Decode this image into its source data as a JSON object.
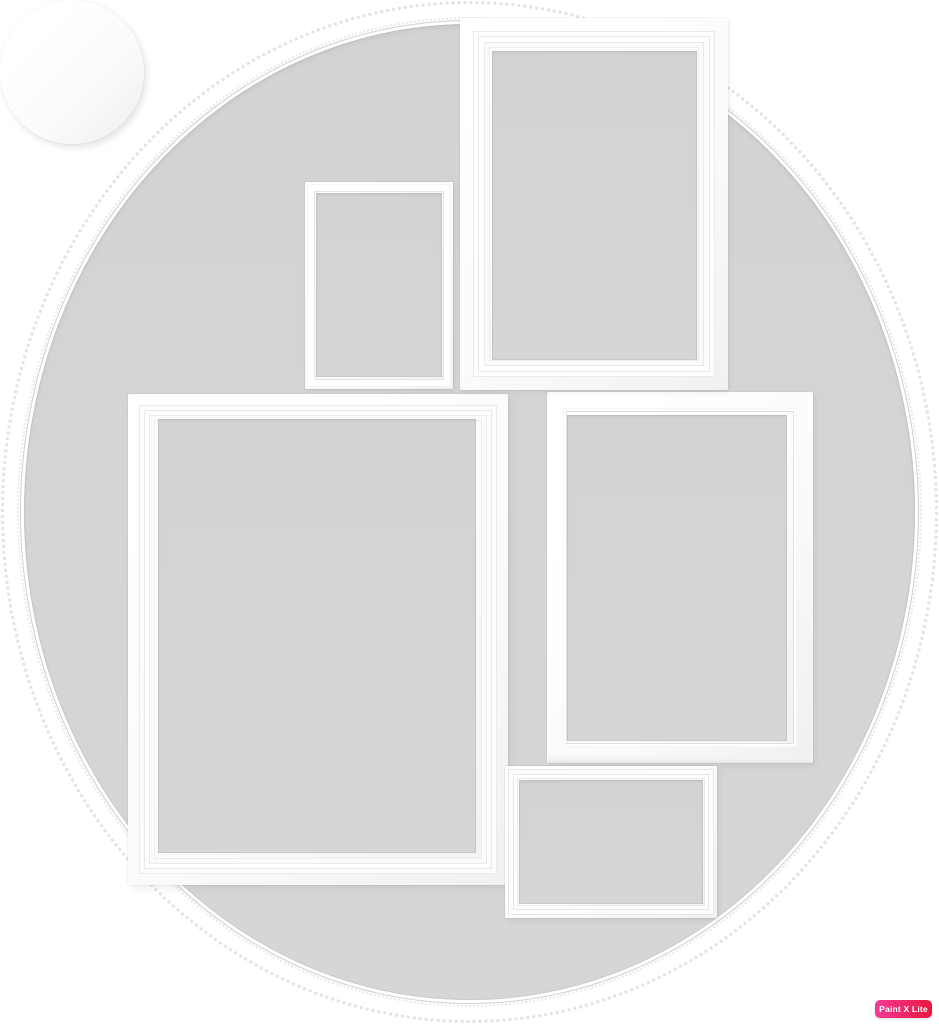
{
  "window": {
    "width_px": 939,
    "height_px": 1024
  },
  "scene": {
    "kind": "product-photo",
    "subject": "Wall collage of six empty white picture frames on a white background",
    "background_color": "#ffffff",
    "frame_color": "#ffffff",
    "opening_color": "#d4d5d5",
    "frames": [
      {
        "id": "frame-portrait-large-top-right",
        "shape": "rectangle",
        "orientation": "portrait",
        "profile": "molded"
      },
      {
        "id": "frame-portrait-small-upper-middle",
        "shape": "rectangle",
        "orientation": "portrait",
        "profile": "thin-flat"
      },
      {
        "id": "frame-round-left",
        "shape": "circle",
        "profile": "beaded"
      },
      {
        "id": "frame-portrait-xlarge-lower-left",
        "shape": "rectangle",
        "orientation": "portrait",
        "profile": "molded"
      },
      {
        "id": "frame-portrait-medium-right",
        "shape": "rectangle",
        "orientation": "portrait",
        "profile": "flat-deep"
      },
      {
        "id": "frame-landscape-small-bottom",
        "shape": "rectangle",
        "orientation": "landscape",
        "profile": "double-ridge"
      }
    ]
  },
  "watermark": {
    "label": "Paint X Lite",
    "text_color": "#ffffff",
    "gradient_start": "#f43a96",
    "gradient_end": "#e9173d"
  }
}
